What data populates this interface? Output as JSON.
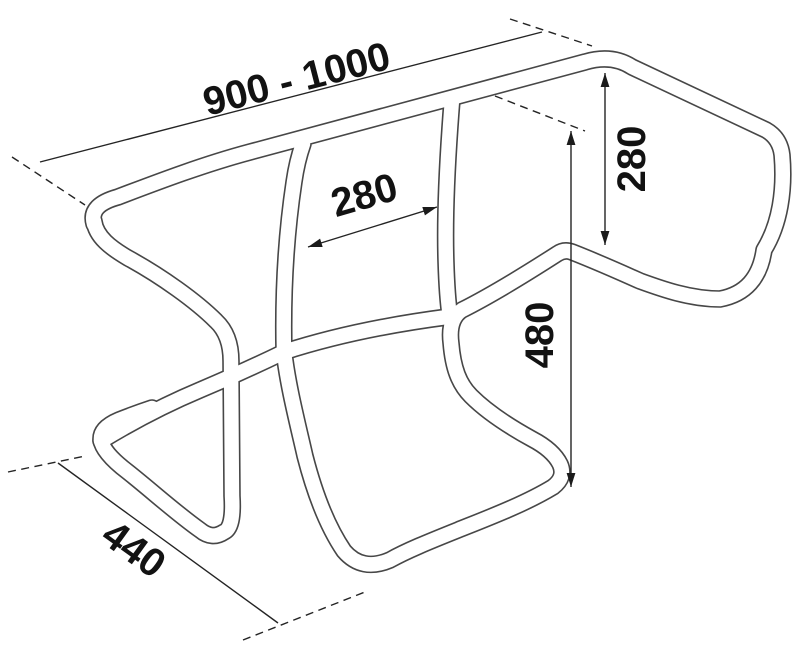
{
  "diagram": {
    "type": "technical-dimension-drawing",
    "subject": "tubular carrier frame",
    "background_color": "#ffffff",
    "tube_line_color": "#474747",
    "dimension_line_color": "#242424",
    "text_color": "#121212",
    "dimensions": [
      {
        "id": "overall-width",
        "label": "900 - 1000",
        "orientation": "diagonal-top",
        "arrowheads": false
      },
      {
        "id": "inner-section-width",
        "label": "280",
        "orientation": "diagonal-middle",
        "arrowheads": true
      },
      {
        "id": "side-panel-height",
        "label": "280",
        "orientation": "vertical-right",
        "arrowheads": true
      },
      {
        "id": "drop-height",
        "label": "480",
        "orientation": "vertical-right",
        "arrowheads": true
      },
      {
        "id": "depth",
        "label": "440",
        "orientation": "diagonal-bottom-left",
        "arrowheads": false
      }
    ]
  }
}
